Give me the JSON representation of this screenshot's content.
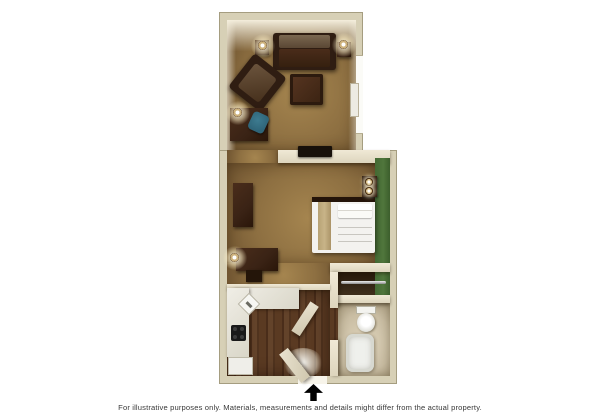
{
  "floorplan": {
    "type": "hotel-studio-suite-floor-plan",
    "rooms": [
      "living-room",
      "bedroom",
      "kitchen",
      "closet",
      "bathroom",
      "entry-hall"
    ],
    "furniture": [
      "sofa",
      "armchair",
      "coffee-table",
      "table-lamp",
      "side-table",
      "work-desk",
      "blue-office-chair",
      "wall-ac-unit",
      "window",
      "flat-tv",
      "dresser",
      "bed",
      "bed-runner",
      "pillows",
      "nightstand",
      "nightstand-lamps",
      "writing-desk",
      "stool",
      "kitchen-counter",
      "sink",
      "cooktop",
      "refrigerator",
      "closet-rod",
      "toilet",
      "bathtub",
      "entry-door",
      "bathroom-door"
    ],
    "colors": {
      "outer_wall": "#d7d0b6",
      "wall_edge": "#a59d80",
      "carpet": "#8d6f41",
      "carpet_light": "#a5854f",
      "wood_floor": "#5a3a22",
      "bathroom_floor": "#c9bda3",
      "accent_wall_green": "#50763c",
      "furniture_wood": "#3a2315",
      "bedding": "#f3f2ef",
      "bed_runner": "#c8b488",
      "chair_blue": "#2f6579",
      "arrow": "#000000"
    }
  },
  "footer": {
    "disclaimer": "For illustrative purposes only.  Materials, measurements and details might differ from the actual property.",
    "entrance_arrow_icon": "up-arrow"
  }
}
